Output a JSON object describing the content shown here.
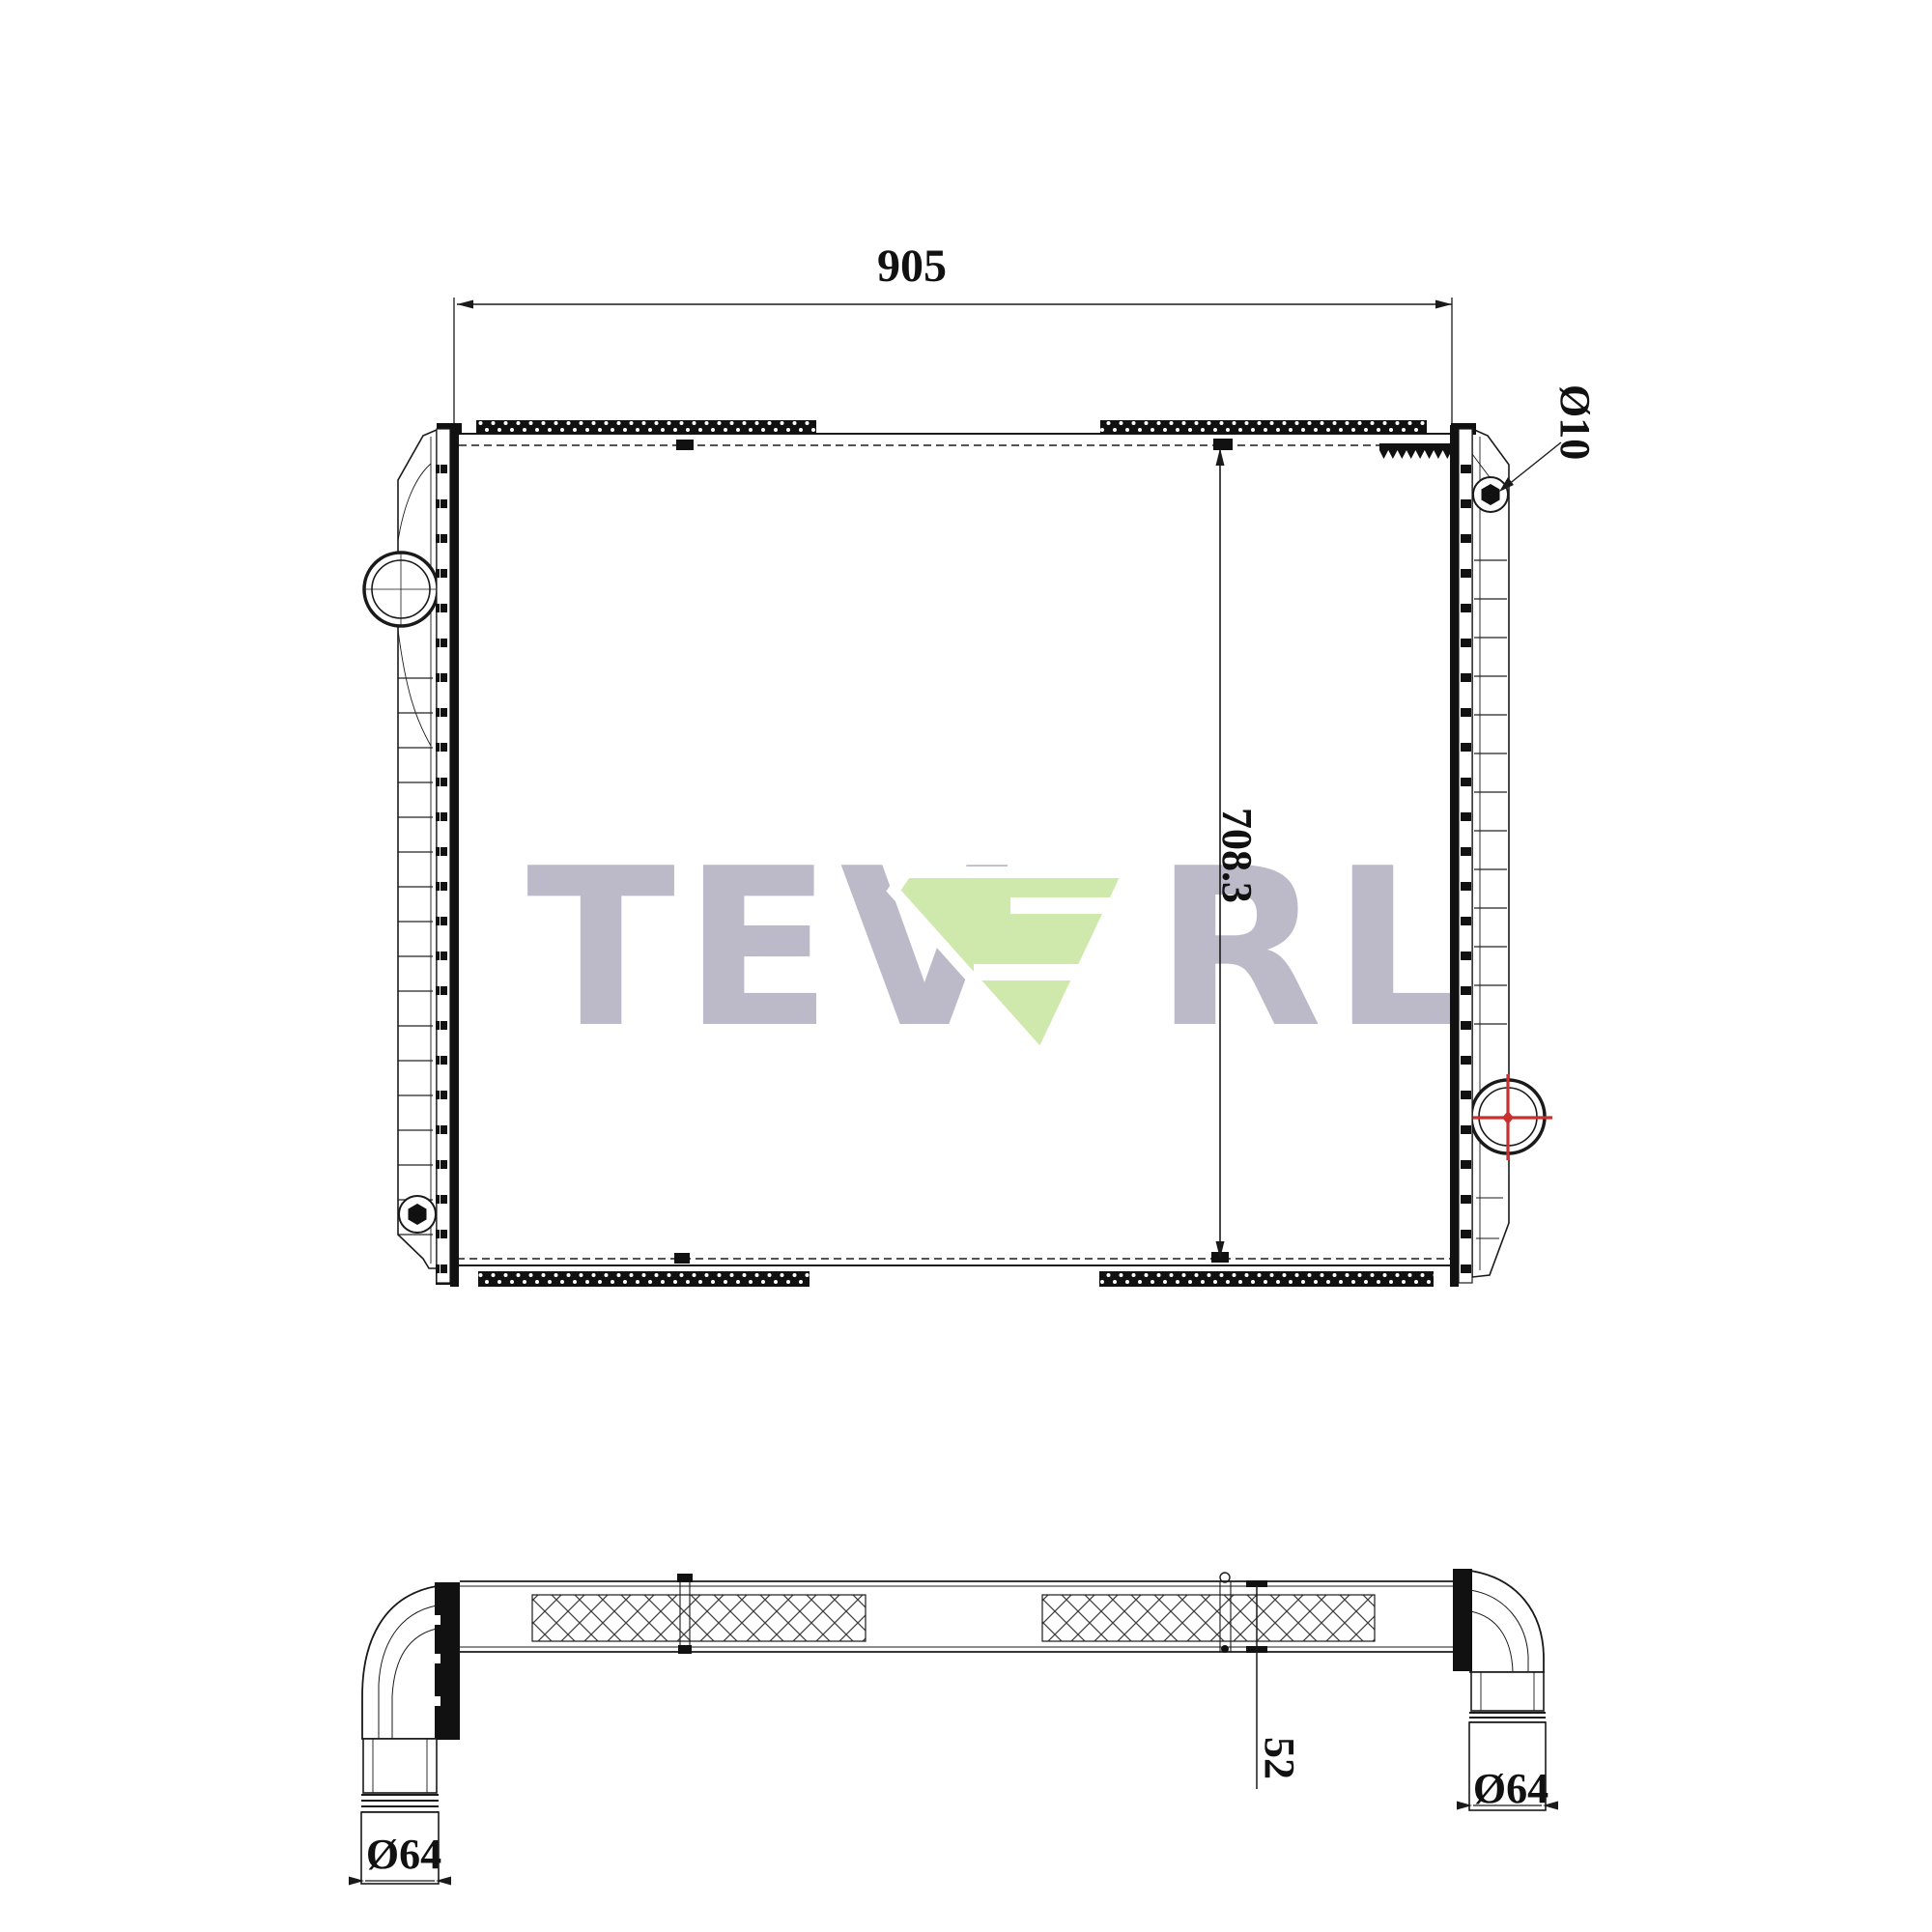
{
  "drawing": {
    "watermark": {
      "part1": "TEV",
      "part2": "RL"
    },
    "front_view": {
      "width_dim": "905",
      "height_dim": "708.3",
      "mount_hole_dim": "Ø10"
    },
    "bottom_view": {
      "left_pipe_dim": "Ø64",
      "right_pipe_dim": "Ø64",
      "depth_dim": "52"
    }
  },
  "colors": {
    "line": "#1a1a1a",
    "crosshair_red": "#c8312e",
    "watermark_gray": "#bcbac9",
    "watermark_green": "#cfe9ad"
  }
}
